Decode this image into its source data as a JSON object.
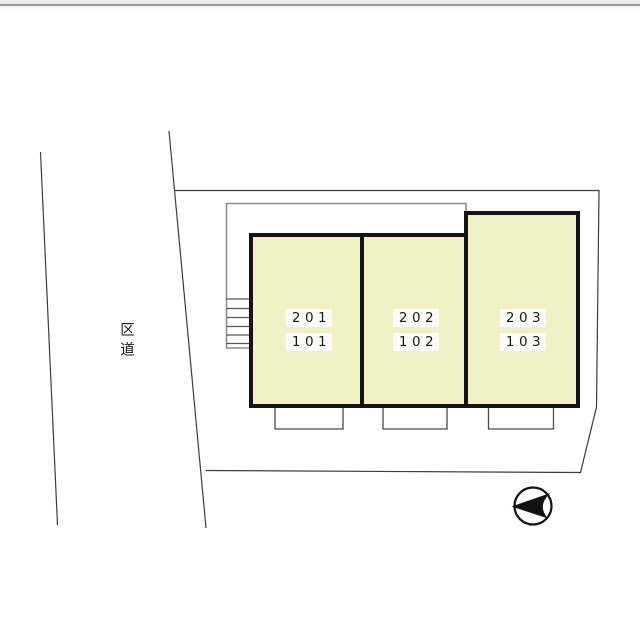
{
  "road": {
    "label": "区道"
  },
  "building": {
    "rooms": [
      {
        "unit_upper": "201",
        "unit_lower": "101"
      },
      {
        "unit_upper": "202",
        "unit_lower": "102"
      },
      {
        "unit_upper": "203",
        "unit_lower": "103"
      }
    ]
  },
  "colors": {
    "room_fill": "#f0f2c5",
    "room_border": "#151515",
    "label_bg": "#fbfbfa",
    "building_outline": "#8a8a8a",
    "boundary_line": "#3c3c3c",
    "porch_line": "#4a4a4a",
    "stair_line": "#555555",
    "compass_ink": "#111111"
  }
}
